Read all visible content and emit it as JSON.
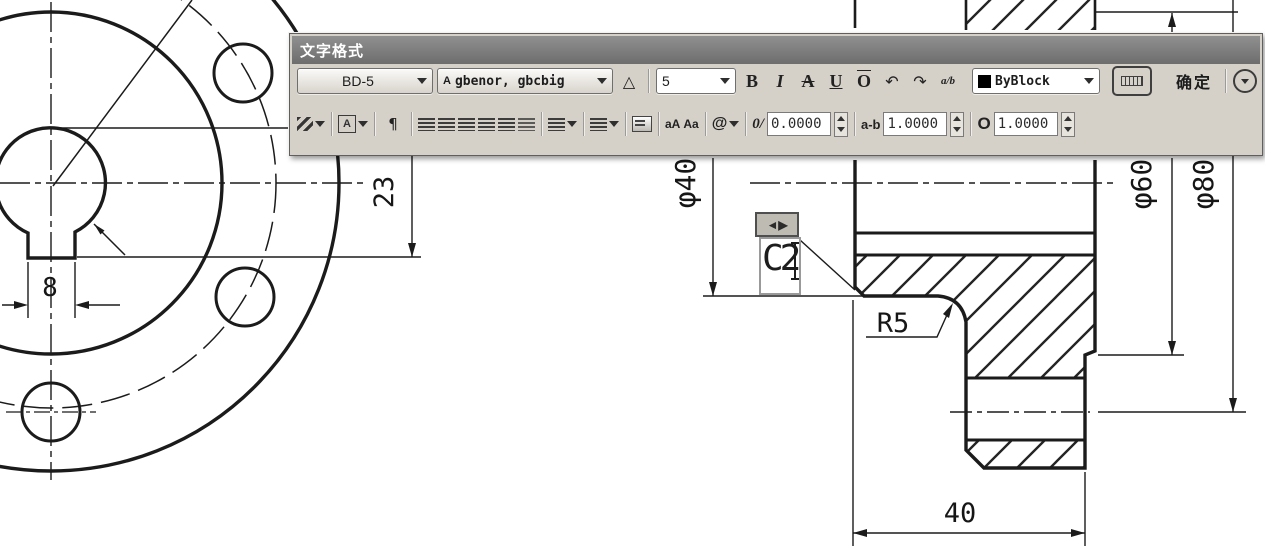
{
  "toolbar": {
    "title": "文字格式",
    "style_value": "BD-5",
    "font_value": "gbenor, gbcbig",
    "size_value": "5",
    "color_value": "ByBlock",
    "ok_label": "确定",
    "glyphs": {
      "font_icon": "A",
      "annotative": "△",
      "bold": "B",
      "italic": "I",
      "strikethrough": "A",
      "underline": "U",
      "overline": "O",
      "undo": "↶",
      "redo": "↷",
      "stack": "a/b",
      "justify_letter": "A",
      "paragraph": "¶",
      "uppercase": "aA",
      "lowercase": "Aa",
      "at": "@",
      "oblique": "0/",
      "tracking": "a-b",
      "width_factor": "O"
    },
    "fields": {
      "oblique_angle": "0.0000",
      "tracking": "1.0000",
      "width_factor": "1.0000"
    },
    "colors": {
      "titlebar": "#7b7b7b",
      "body": "#d5d1c9",
      "swatch": "#000000"
    }
  },
  "drawing": {
    "dim_keyway_width": "8",
    "dim_keyway_depth": "23",
    "dim_dia_small": "φ40",
    "dim_dia_mid": "φ60",
    "dim_dia_large": "φ80",
    "dim_fillet": "R5",
    "dim_length": "40",
    "editor": {
      "text": "C2",
      "grip_glyph": "◄▶"
    },
    "line_color": "#1b1b1b"
  }
}
